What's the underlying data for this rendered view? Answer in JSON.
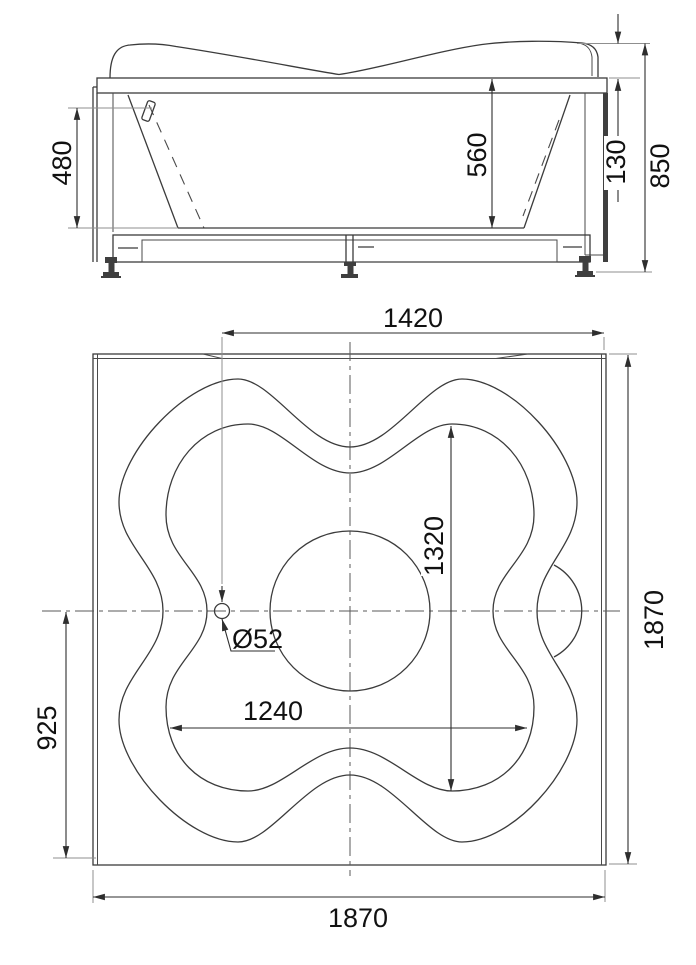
{
  "sheet": {
    "background": "#ffffff",
    "kind": "bathtub-installation-drawing"
  },
  "elevation": {
    "dims": {
      "inner_depth_left": "480",
      "inner_depth_right": "560",
      "rim_band_height": "130",
      "overall_height": "850"
    }
  },
  "plan": {
    "dims": {
      "top_width": "1420",
      "basin_inner_height": "1320",
      "basin_inner_width": "1240",
      "drain_offset": "925",
      "overall_depth": "1870",
      "overall_width": "1870",
      "drain_diameter": "Ø52"
    }
  },
  "colors": {
    "object_line": "#3b3b3b",
    "dimension_line": "#2e2e2e",
    "extension_line": "#8f8f8f",
    "text": "#111111",
    "background": "#ffffff"
  }
}
